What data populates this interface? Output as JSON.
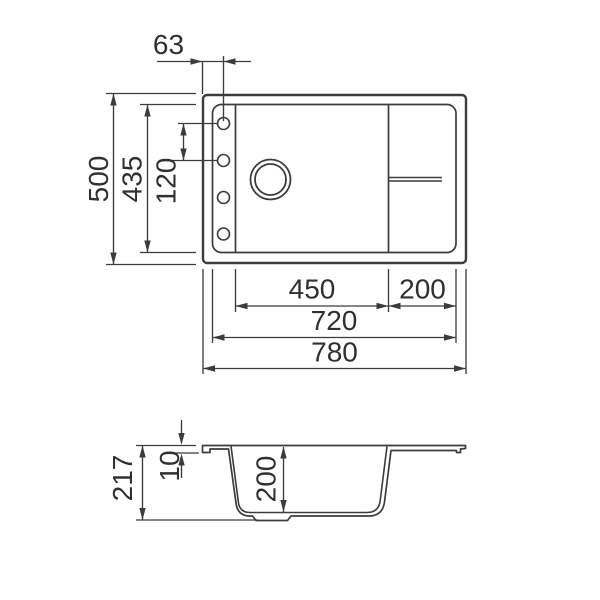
{
  "colors": {
    "line": "#3c3c3c",
    "text": "#303030",
    "background": "#ffffff"
  },
  "top_view": {
    "hole_offset": "63",
    "overall_depth": "500",
    "inner_depth": "435",
    "hole_spacing": "120",
    "bowl_width": "450",
    "drainer_width": "200",
    "inner_width": "720",
    "overall_width": "780"
  },
  "section_view": {
    "total_height": "217",
    "rim_thickness": "10",
    "bowl_depth": "200"
  }
}
